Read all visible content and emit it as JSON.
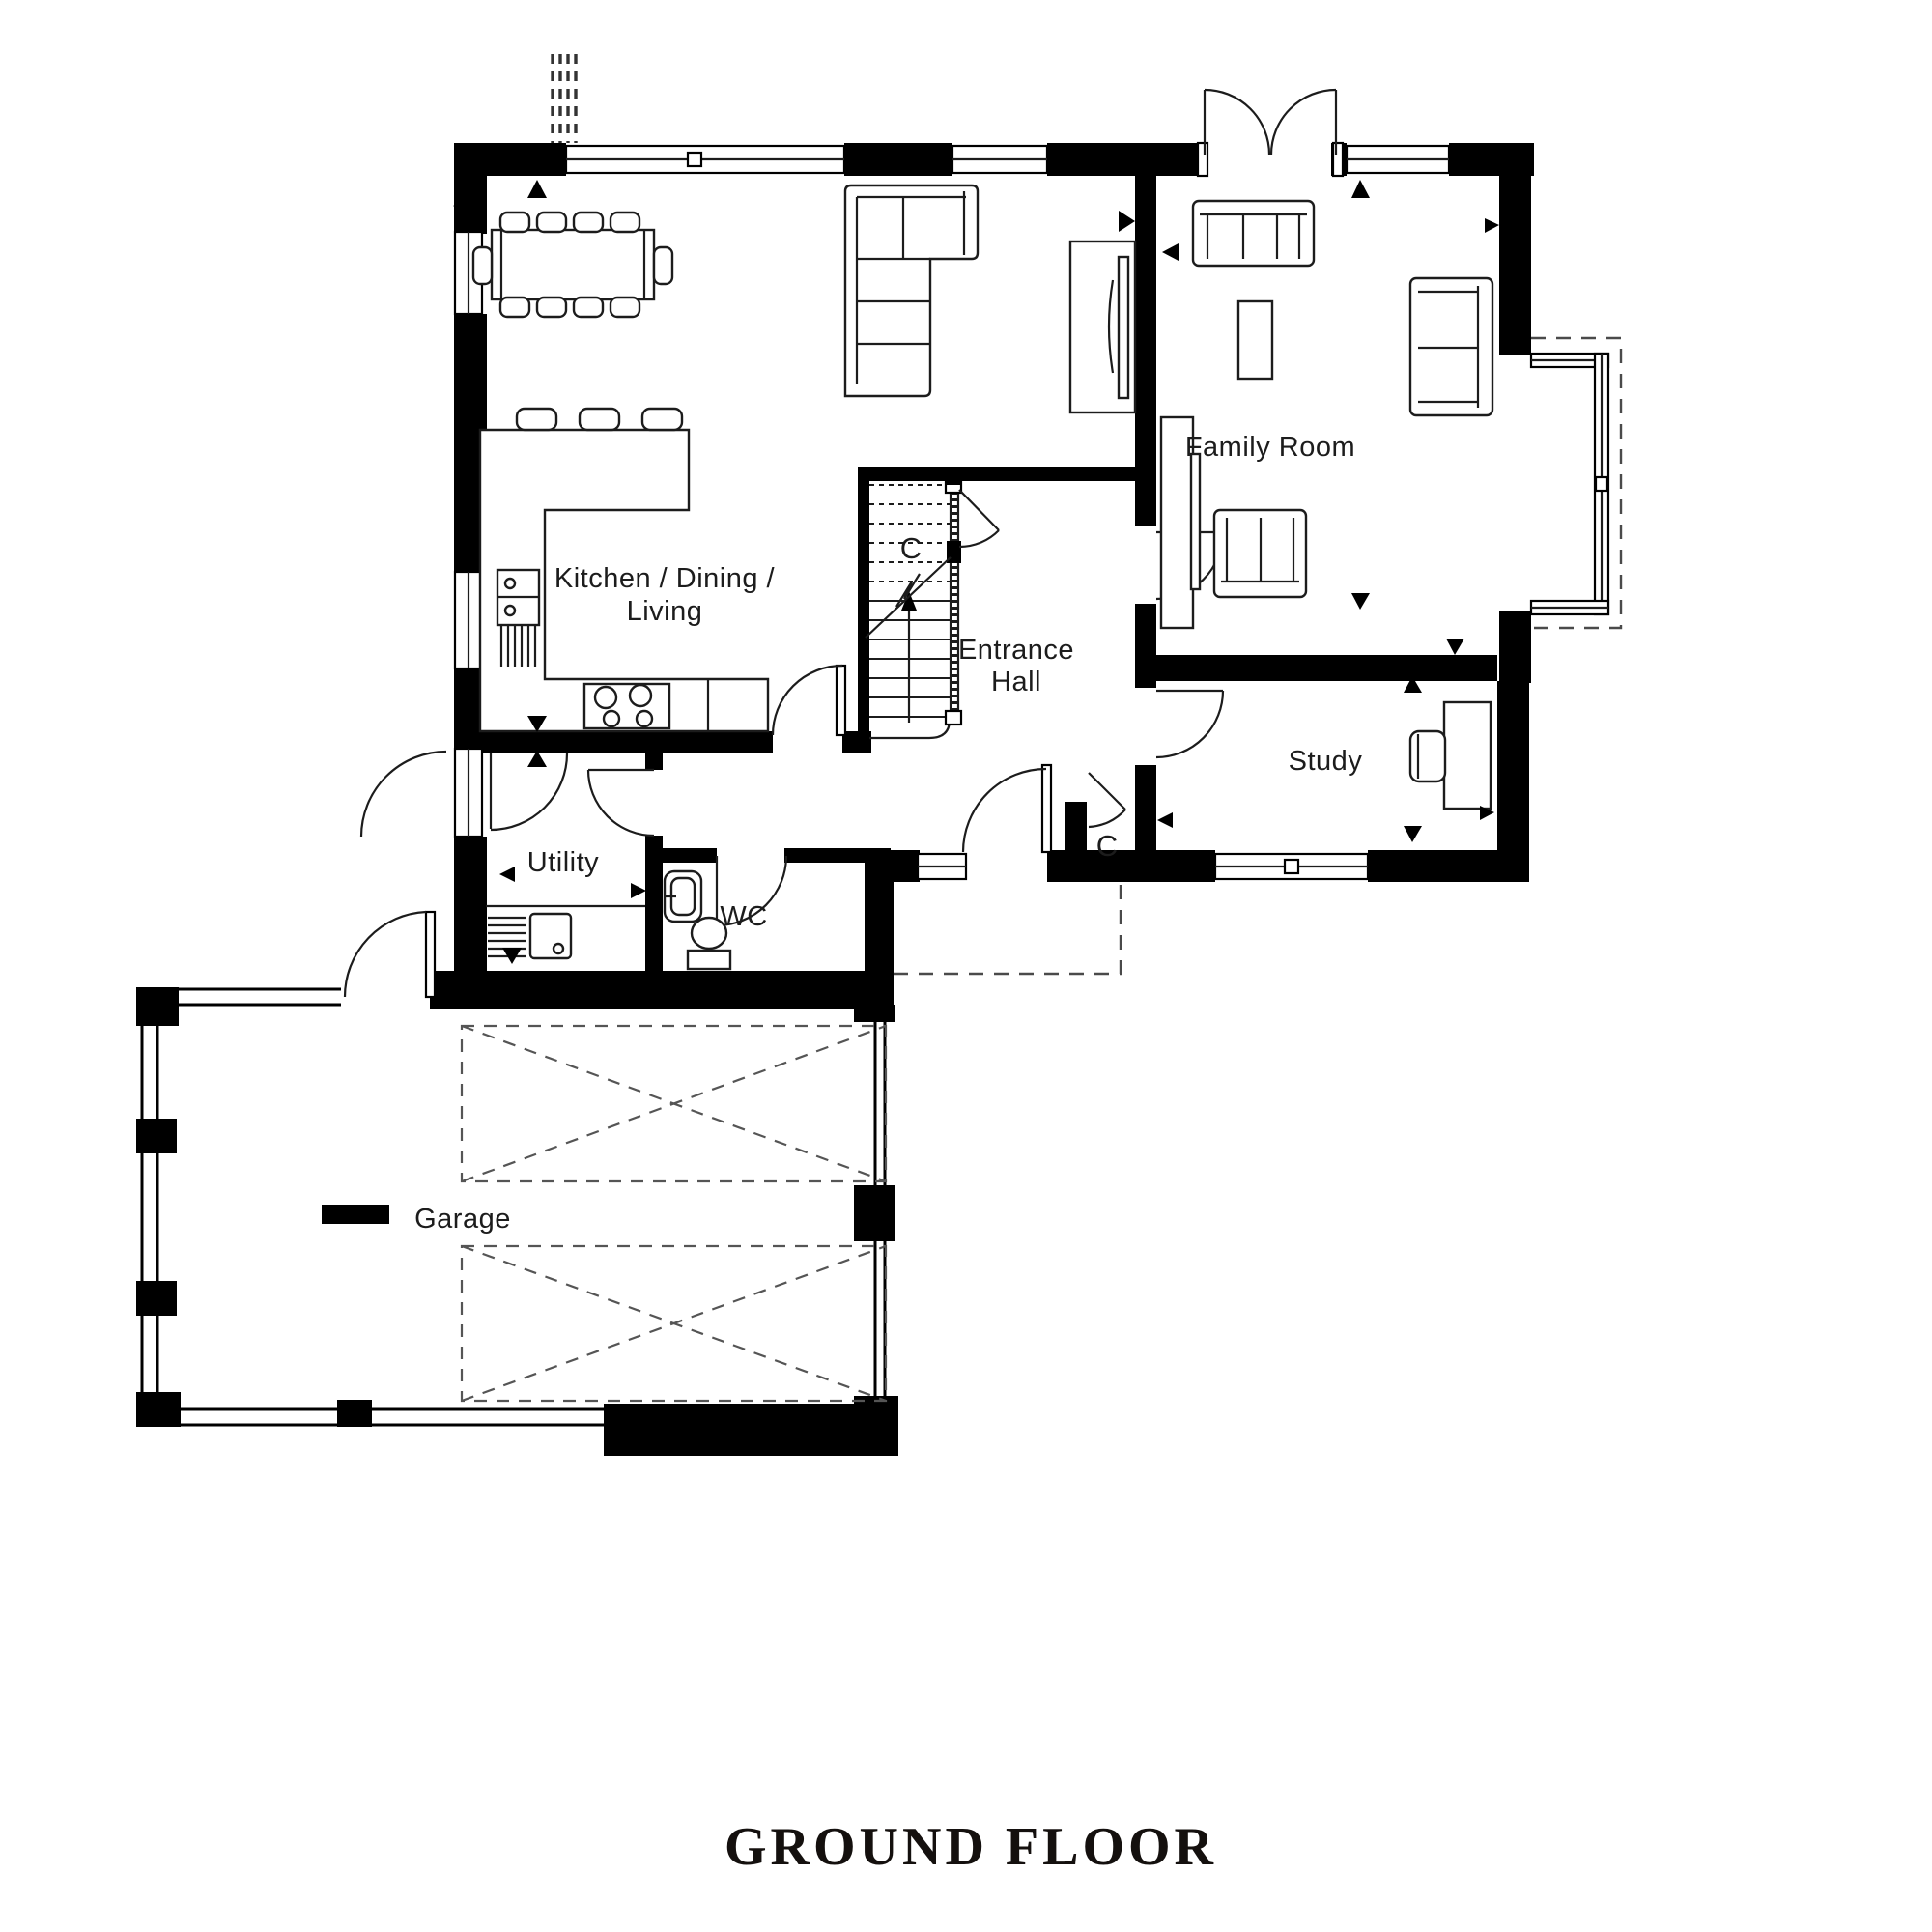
{
  "title": {
    "text": "GROUND FLOOR"
  },
  "rooms": {
    "kitchen_dining_living": {
      "label_line1": "Kitchen / Dining /",
      "label_line2": "Living"
    },
    "entrance_hall": {
      "label_line1": "Entrance",
      "label_line2": "Hall"
    },
    "family_room": {
      "label": "Family Room"
    },
    "study": {
      "label": "Study"
    },
    "utility": {
      "label": "Utility"
    },
    "wc": {
      "label": "WC"
    },
    "garage": {
      "label": "Garage"
    }
  },
  "annotations": {
    "stairs_cupboard": "C",
    "hall_cupboard": "C"
  },
  "colors": {
    "walls": "#000000",
    "lines": "#1c1c1c",
    "background": "#ffffff"
  }
}
